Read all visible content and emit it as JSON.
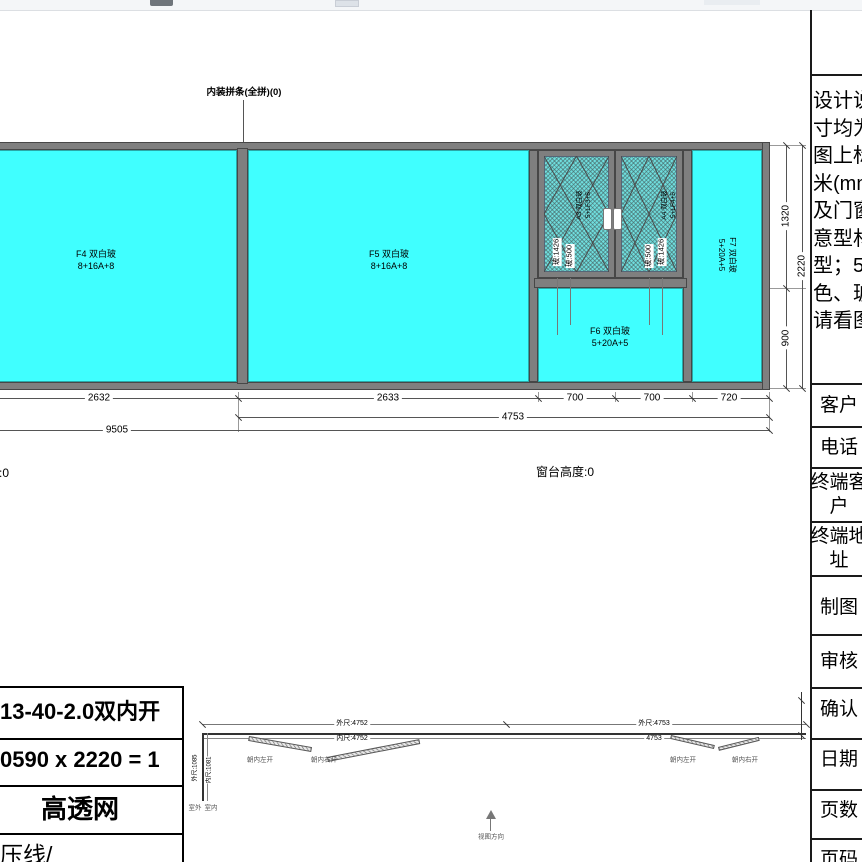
{
  "drawing": {
    "joint_label": "内装拼条(全拼)(0)",
    "f4_name": "F4 双白玻",
    "f4_spec": "8+16A+8",
    "f5_name": "F5 双白玻",
    "f5_spec": "8+16A+8",
    "f6_name": "F6 双白玻",
    "f6_spec": "5+20A+5",
    "f7_name": "F7 双白玻",
    "f7_spec": "5+20A+5",
    "sash_left_name": "A3 双白玻",
    "sash_left_spec": "5+LF3+5",
    "sash_right_name": "A4 双白玻",
    "sash_right_spec": "5+LF4+5",
    "glass_h": "玻:1426",
    "glass_w": "玻:500",
    "dim_2632": "2632",
    "dim_2633": "2633",
    "dim_700a": "700",
    "dim_700b": "700",
    "dim_720": "720",
    "dim_4753": "4753",
    "dim_9505": "9505",
    "dim_1320": "1320",
    "dim_900": "900",
    "dim_2220": "2220",
    "sill_label": "窗台高度:0"
  },
  "plan": {
    "outer_left": "外尺:4752",
    "inner_left": "内尺:4752",
    "outer_right": "外尺:4753",
    "inner_right": "4753",
    "side_outer": "外尺:1085",
    "side_inner": "内尺:1081",
    "leaf_left": "朝内左开",
    "leaf_right": "朝内右开",
    "outside": "室外",
    "inside": "室内",
    "view_dir": "视图方向"
  },
  "order": {
    "row1": "13-40-2.0双内开",
    "row2": "0590 x 2220 = 1",
    "row3": "高透网",
    "row4": "压线/"
  },
  "sidebar": {
    "notes": [
      "设计说",
      "寸均为",
      "图上标",
      "米(mm",
      "及门窗",
      "意型材",
      "型；5",
      "色、玻",
      "请看图"
    ],
    "rows": [
      "客户",
      "电话",
      "终端客户",
      "终端地址",
      "制图",
      "审核",
      "确认",
      "日期",
      "页数",
      "页码"
    ]
  },
  "colors": {
    "glass": "#40ffff",
    "frame": "#7f7f7f",
    "mesh": "#6fdede"
  }
}
